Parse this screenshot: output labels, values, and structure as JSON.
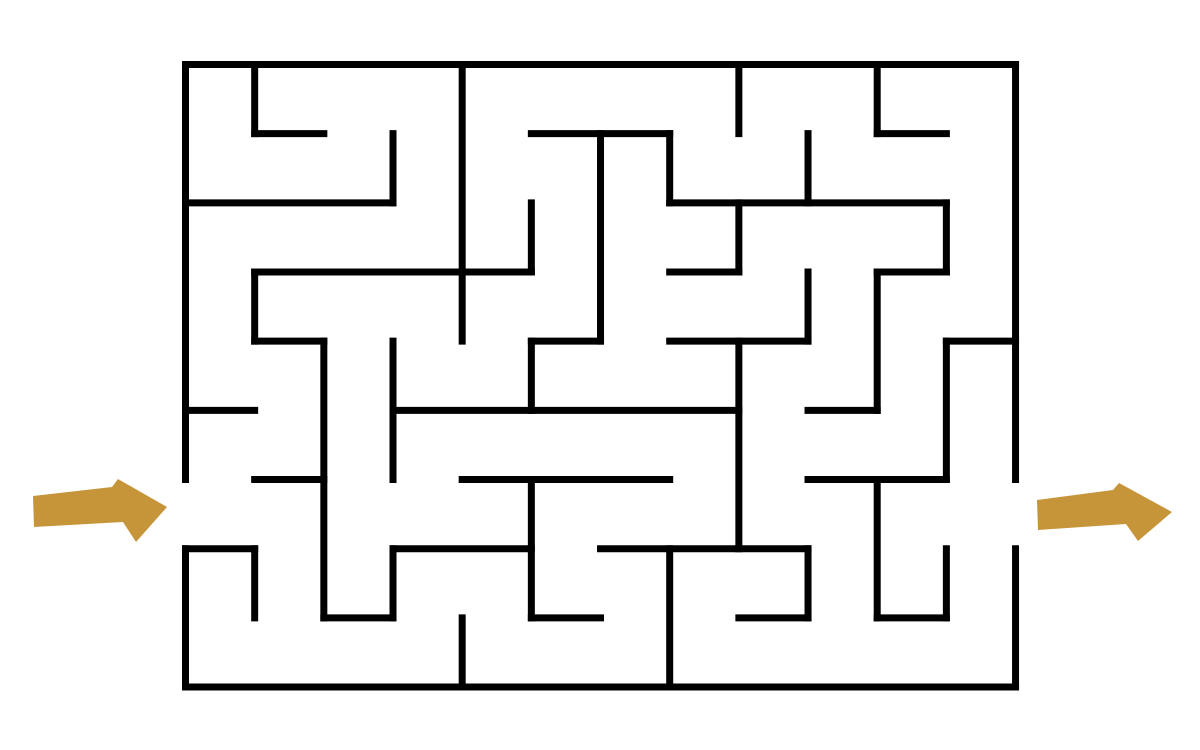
{
  "canvas": {
    "width": 1200,
    "height": 750,
    "background": "#ffffff"
  },
  "maze": {
    "grid": {
      "cols": 12,
      "rows": 9,
      "cell_size": 69.17,
      "origin_x": 185.5,
      "origin_y": 64.5
    },
    "style": {
      "wall_color": "#000000",
      "wall_thickness": 7,
      "linecap": "square"
    },
    "openings": {
      "entrance": {
        "side": "left",
        "row": 6
      },
      "exit": {
        "side": "right",
        "row": 6
      }
    },
    "h_walls": [
      [
        0,
        0,
        12
      ],
      [
        1,
        1,
        2
      ],
      [
        1,
        5,
        7
      ],
      [
        1,
        10,
        11
      ],
      [
        2,
        0,
        3
      ],
      [
        2,
        7,
        11
      ],
      [
        3,
        1,
        5
      ],
      [
        3,
        7,
        8
      ],
      [
        3,
        10,
        11
      ],
      [
        4,
        1,
        2
      ],
      [
        4,
        5,
        6
      ],
      [
        4,
        7,
        9
      ],
      [
        4,
        11,
        12
      ],
      [
        5,
        0,
        1
      ],
      [
        5,
        3,
        8
      ],
      [
        5,
        9,
        10
      ],
      [
        6,
        1,
        2
      ],
      [
        6,
        4,
        7
      ],
      [
        6,
        9,
        11
      ],
      [
        7,
        0,
        1
      ],
      [
        7,
        3,
        5
      ],
      [
        7,
        6,
        9
      ],
      [
        8,
        2,
        3
      ],
      [
        8,
        5,
        6
      ],
      [
        8,
        8,
        9
      ],
      [
        8,
        10,
        11
      ],
      [
        9,
        0,
        12
      ]
    ],
    "v_walls": [
      [
        0,
        0,
        6
      ],
      [
        0,
        7,
        9
      ],
      [
        1,
        0,
        1
      ],
      [
        1,
        3,
        4
      ],
      [
        1,
        7,
        8
      ],
      [
        2,
        4,
        8
      ],
      [
        3,
        1,
        2
      ],
      [
        3,
        4,
        6
      ],
      [
        3,
        7,
        8
      ],
      [
        4,
        0,
        4
      ],
      [
        4,
        8,
        9
      ],
      [
        5,
        2,
        3
      ],
      [
        5,
        4,
        5
      ],
      [
        5,
        6,
        8
      ],
      [
        6,
        1,
        4
      ],
      [
        7,
        1,
        2
      ],
      [
        7,
        7,
        9
      ],
      [
        8,
        0,
        1
      ],
      [
        8,
        2,
        3
      ],
      [
        8,
        4,
        7
      ],
      [
        9,
        1,
        2
      ],
      [
        9,
        3,
        4
      ],
      [
        9,
        7,
        8
      ],
      [
        10,
        0,
        1
      ],
      [
        10,
        3,
        5
      ],
      [
        10,
        6,
        8
      ],
      [
        11,
        2,
        3
      ],
      [
        11,
        4,
        6
      ],
      [
        11,
        7,
        8
      ],
      [
        12,
        0,
        6
      ],
      [
        12,
        7,
        9
      ]
    ]
  },
  "arrows": {
    "color": "#C79539",
    "entrance": {
      "direction": "right",
      "points": [
        [
          33,
          496
        ],
        [
          112,
          487
        ],
        [
          118,
          479
        ],
        [
          167,
          507
        ],
        [
          136,
          542
        ],
        [
          123,
          522
        ],
        [
          34,
          527
        ]
      ]
    },
    "exit": {
      "direction": "right",
      "points": [
        [
          1037,
          500
        ],
        [
          1113,
          490
        ],
        [
          1119,
          483
        ],
        [
          1172,
          512
        ],
        [
          1138,
          541
        ],
        [
          1126,
          524
        ],
        [
          1038,
          530
        ]
      ]
    }
  }
}
